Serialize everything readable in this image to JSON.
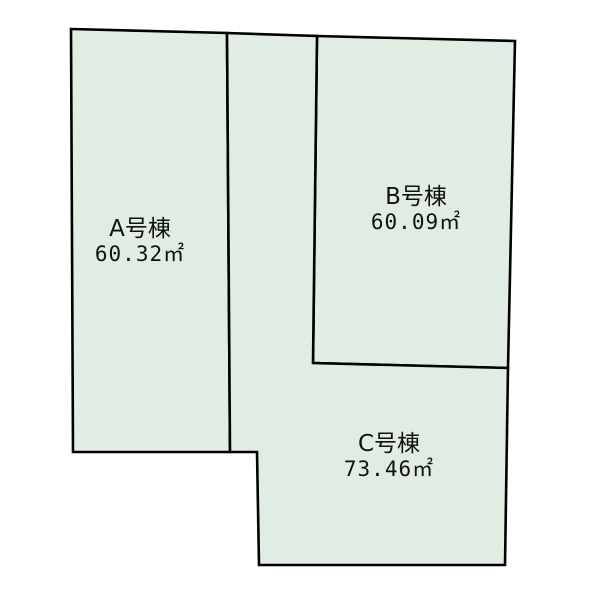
{
  "diagram": {
    "kind": "land-plot-layout",
    "colors": {
      "background": "#ffffff",
      "parcel_fill": "#e1ede2",
      "outline": "#000000",
      "text": "#111111"
    },
    "parcels": [
      {
        "name": "A号棟",
        "area_value": "60.32",
        "area_unit": "㎡"
      },
      {
        "name": "B号棟",
        "area_value": "60.09",
        "area_unit": "㎡"
      },
      {
        "name": "C号棟",
        "area_value": "73.46",
        "area_unit": "㎡"
      }
    ]
  }
}
